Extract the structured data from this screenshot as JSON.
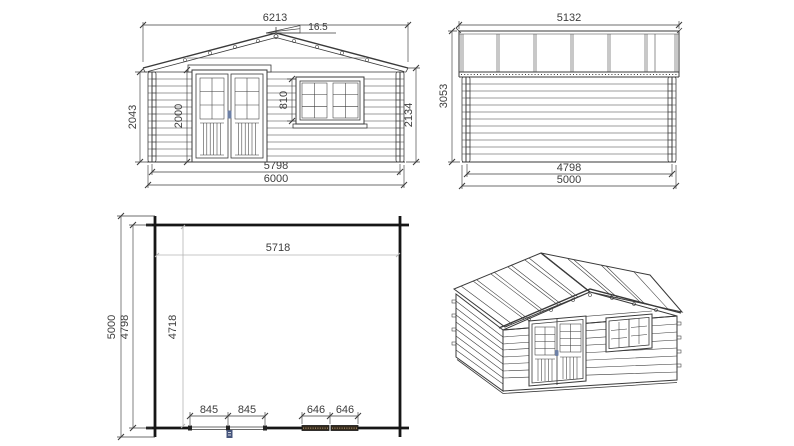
{
  "colors": {
    "background": "#ffffff",
    "line": "#3a3a3a",
    "dim": "#3d3d3d",
    "wall": "#161616",
    "light_line": "#b5b5b5",
    "plan_window_fill": "#352a1d",
    "plan_window_hatch": "#9b8563",
    "door_marker": "#46557c",
    "handle": "#6d80a6"
  },
  "front": {
    "dims": {
      "roof_width": "6213",
      "roof_pitch": "16.5",
      "left_height": "2043",
      "door_height": "2000",
      "window_height": "810",
      "right_height": "2134",
      "wall_width": "5798",
      "base_width": "6000"
    }
  },
  "side": {
    "dims": {
      "roof_length": "5132",
      "height": "3053",
      "wall_depth": "4798",
      "base_depth": "5000"
    }
  },
  "plan": {
    "dims": {
      "inner_width": "5718",
      "base_depth": "5000",
      "wall_depth": "4798",
      "inner_depth": "4718",
      "door_left": "845",
      "door_right": "845",
      "window_left": "646",
      "window_right": "646"
    }
  }
}
